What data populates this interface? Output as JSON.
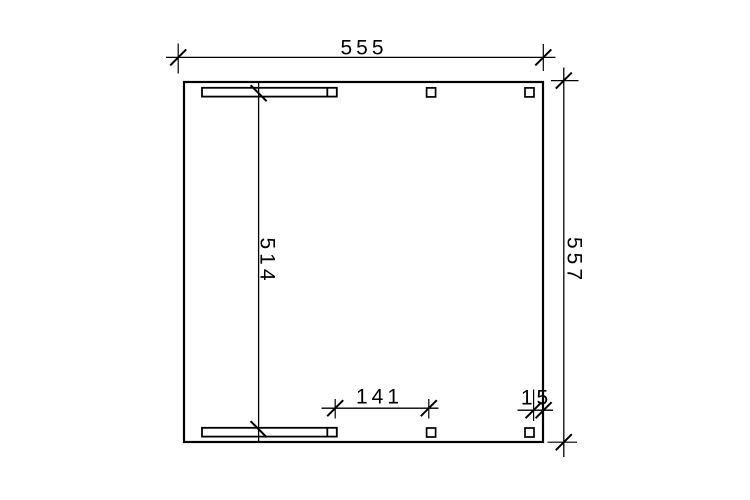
{
  "drawing": {
    "type": "construction-plan-top-view",
    "dimensions": {
      "overall_width": "555",
      "overall_depth": "557",
      "inner_span": "514",
      "post_spacing": "141",
      "edge_offset": "15"
    },
    "colors": {
      "line": "#000000",
      "background": "#ffffff"
    }
  }
}
